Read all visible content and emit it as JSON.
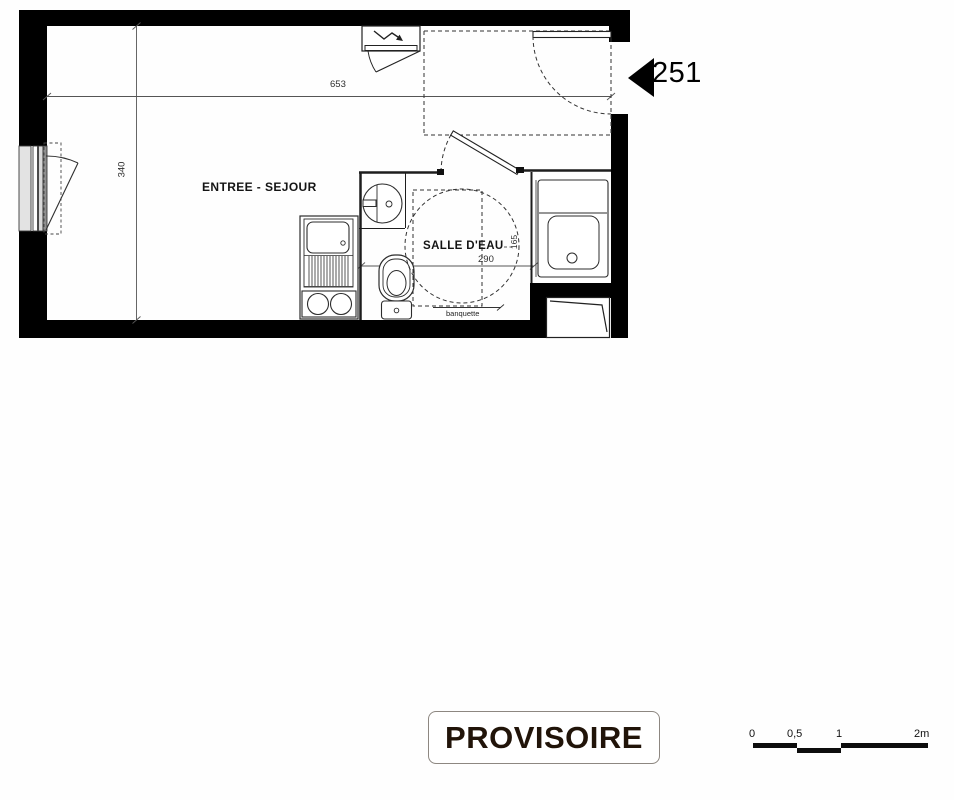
{
  "plan": {
    "unit_label": "251",
    "room_labels": {
      "living": "ENTREE - SEJOUR",
      "bathroom": "SALLE D'EAU",
      "bench": "banquette"
    },
    "dimensions": {
      "living_width": "653",
      "living_depth": "340",
      "bathroom_width": "290",
      "bathroom_depth": "165"
    },
    "stamp": {
      "text": "PROVISOIRE"
    },
    "scale_bar": {
      "labels": [
        "0",
        "0,5",
        "1",
        "2m"
      ]
    },
    "colors": {
      "wall": "#000000",
      "thin_line": "#333333",
      "stamp_text": "#211409",
      "stamp_border": "#8d8781"
    }
  }
}
